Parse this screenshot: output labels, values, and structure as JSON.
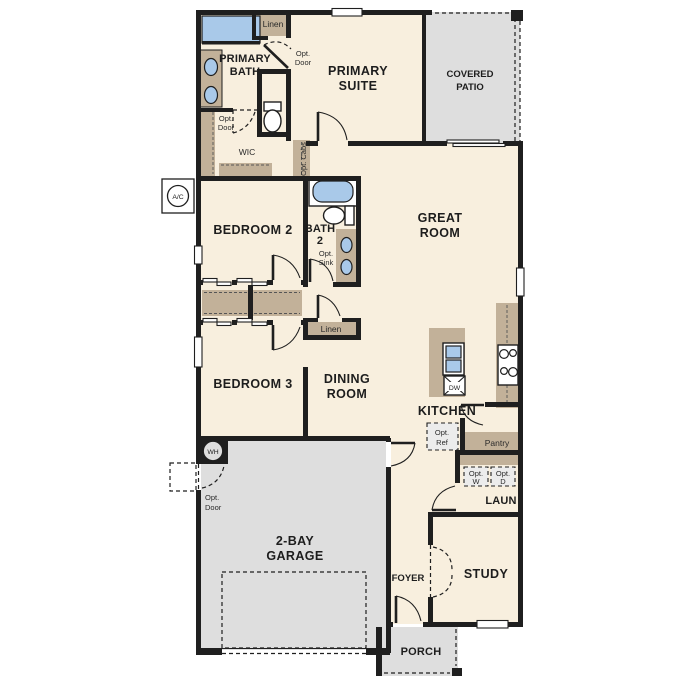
{
  "palette": {
    "wall": "#1f1f1f",
    "interior": "#f8efde",
    "outdoor": "#dedede",
    "cabinet": "#c2b199",
    "fixture_blue": "#a9c9e9"
  },
  "labels": {
    "primary_bath_l1": "PRIMARY",
    "primary_bath_l2": "BATH",
    "primary_suite_l1": "PRIMARY",
    "primary_suite_l2": "SUITE",
    "covered_patio_l1": "COVERED",
    "covered_patio_l2": "PATIO",
    "linen_top": "Linen",
    "opt_door_suite_l1": "Opt.",
    "opt_door_suite_l2": "Door",
    "opt_door_wic_l1": "Opt.",
    "opt_door_wic_l2": "Door",
    "wic": "WIC",
    "opt_cabs": "Opt. Cabs",
    "bedroom_2": "BEDROOM 2",
    "bath_2_l1": "BATH",
    "bath_2_l2": "2",
    "opt_sink_l1": "Opt.",
    "opt_sink_l2": "Sink",
    "great_room_l1": "GREAT",
    "great_room_l2": "ROOM",
    "linen_hall": "Linen",
    "bedroom_3": "BEDROOM 3",
    "dining_room_l1": "DINING",
    "dining_room_l2": "ROOM",
    "kitchen": "KITCHEN",
    "dw": "DW",
    "opt_ref_l1": "Opt.",
    "opt_ref_l2": "Ref",
    "pantry": "Pantry",
    "opt_w_l1": "Opt.",
    "opt_w_l2": "W",
    "opt_d_l1": "Opt.",
    "opt_d_l2": "D",
    "laun": "LAUN",
    "study": "STUDY",
    "foyer": "FOYER",
    "garage_l1": "2-BAY",
    "garage_l2": "GARAGE",
    "porch": "PORCH",
    "wh": "WH",
    "ac": "A/C",
    "opt_door_garage_l1": "Opt.",
    "opt_door_garage_l2": "Door"
  }
}
